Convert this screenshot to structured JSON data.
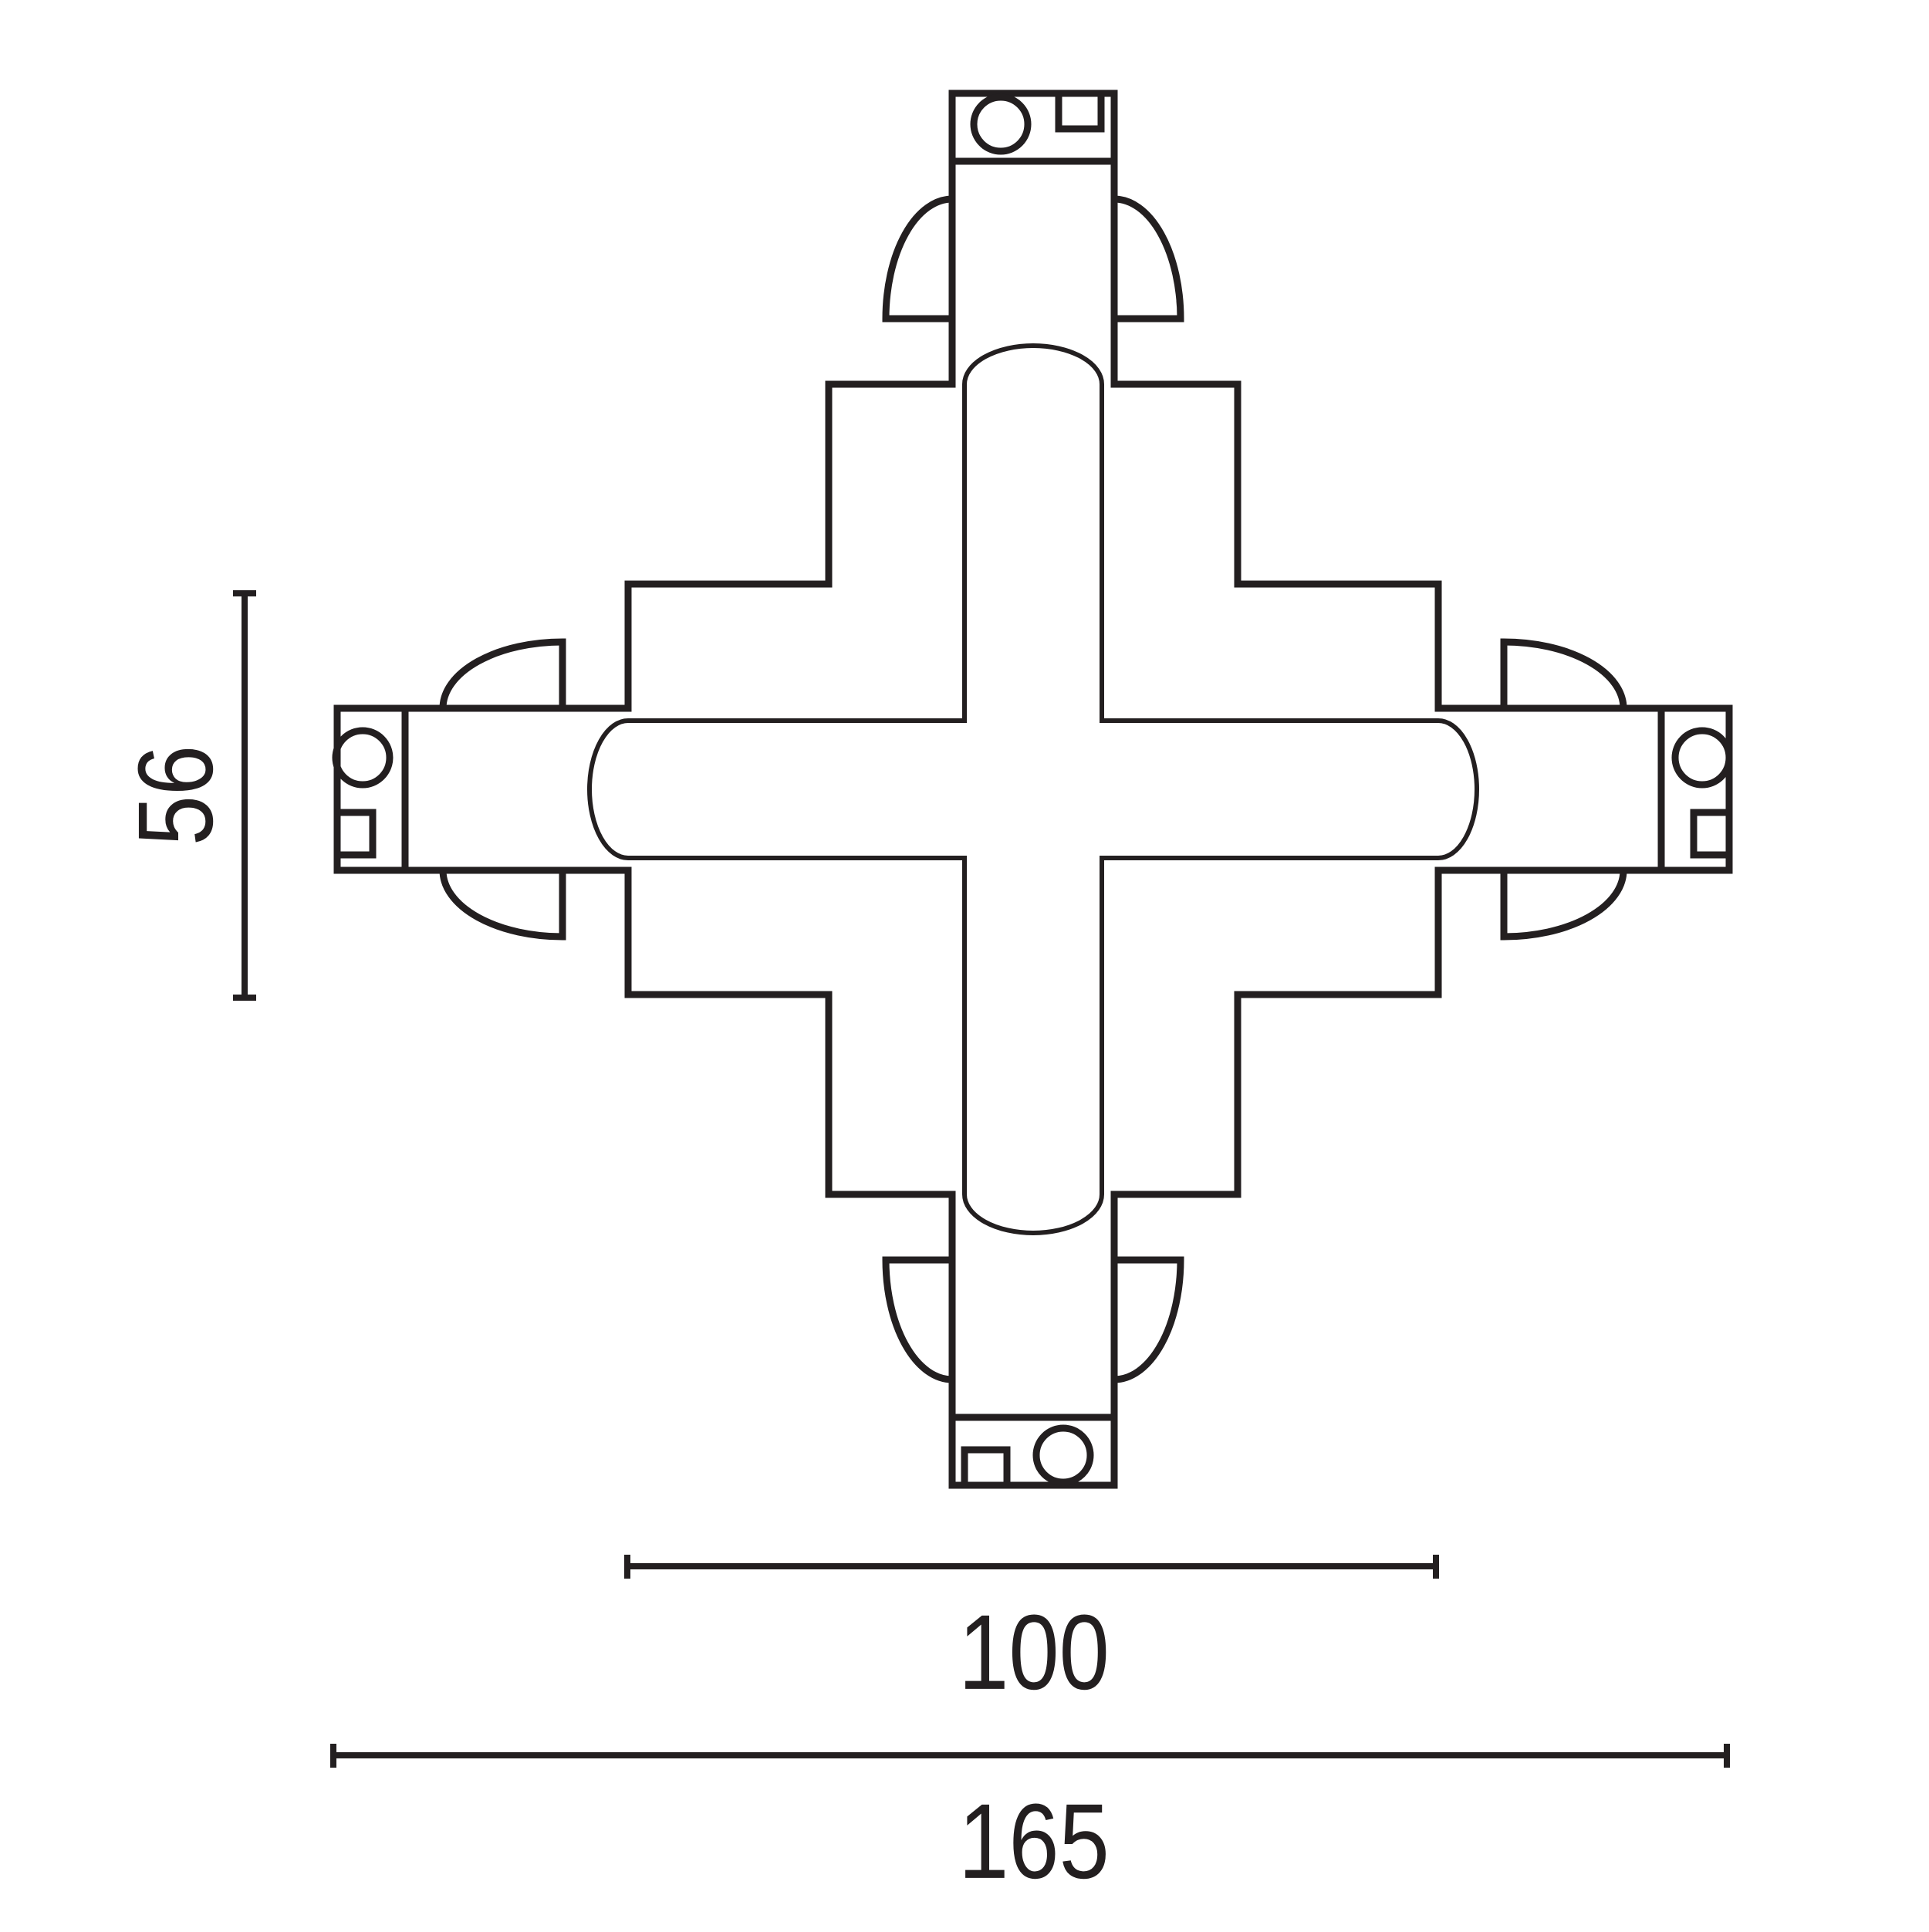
{
  "diagram": {
    "description": "X-shaped 4-way track connector technical drawing, top view",
    "dimension_labels": {
      "side_height": "56",
      "inner_width": "100",
      "overall_width": "165"
    }
  },
  "colors": {
    "line": "#231f20",
    "background": "#ffffff"
  }
}
